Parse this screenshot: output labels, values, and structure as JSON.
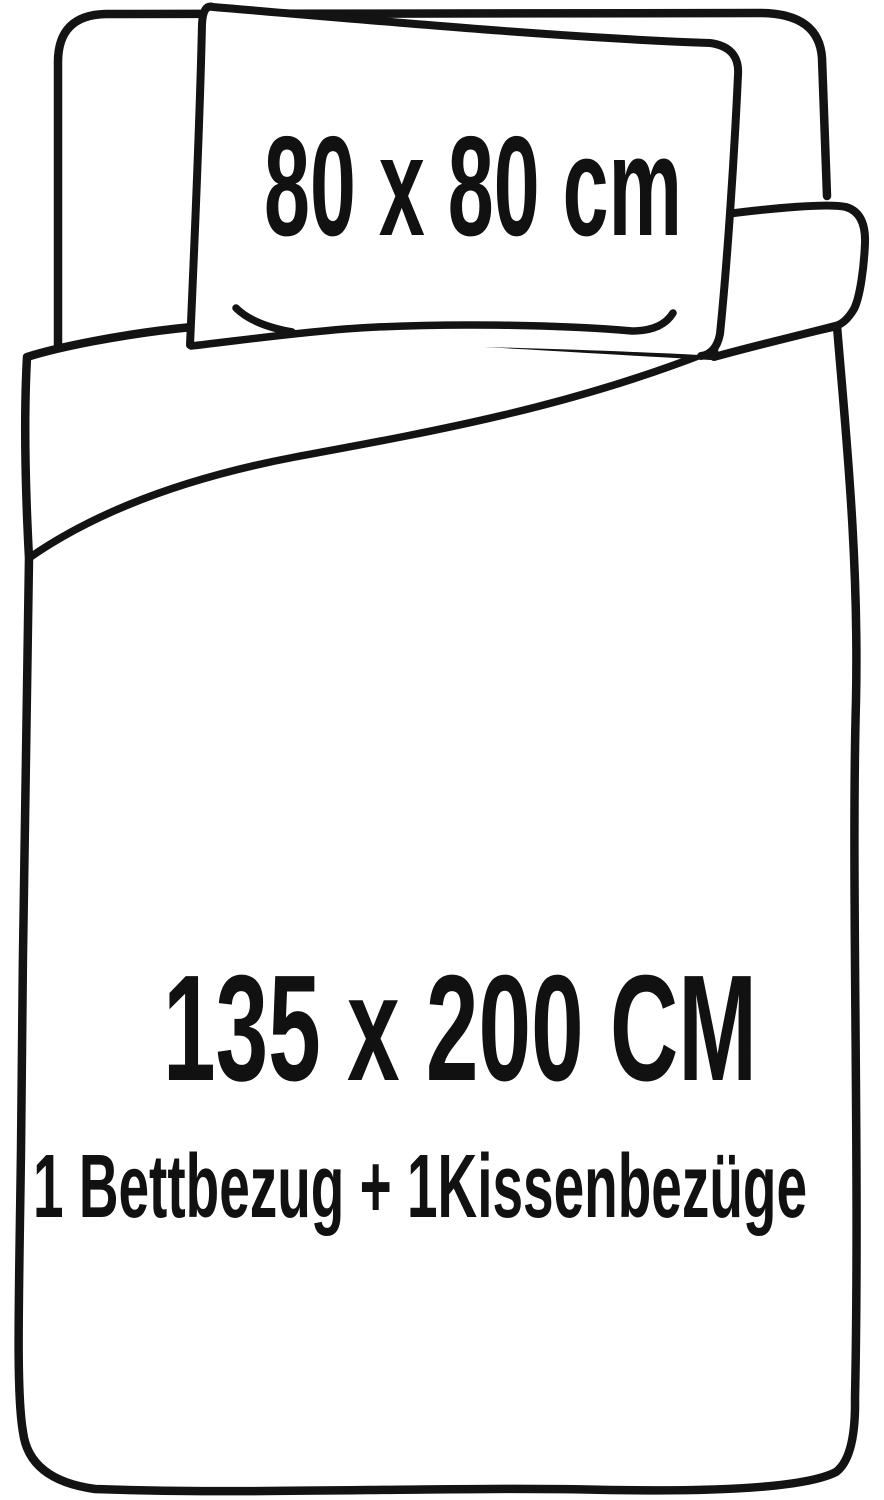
{
  "diagram": {
    "description": "bedding-set-size-diagram",
    "background_color": "#ffffff",
    "line_color": "#131313",
    "text_color": "#111111",
    "pillow": {
      "size_label": "80 x 80 cm"
    },
    "duvet": {
      "size_label": "135 x 200 CM"
    },
    "set_contents_label": "1 Bettbezug + 1Kissenbezüge"
  }
}
